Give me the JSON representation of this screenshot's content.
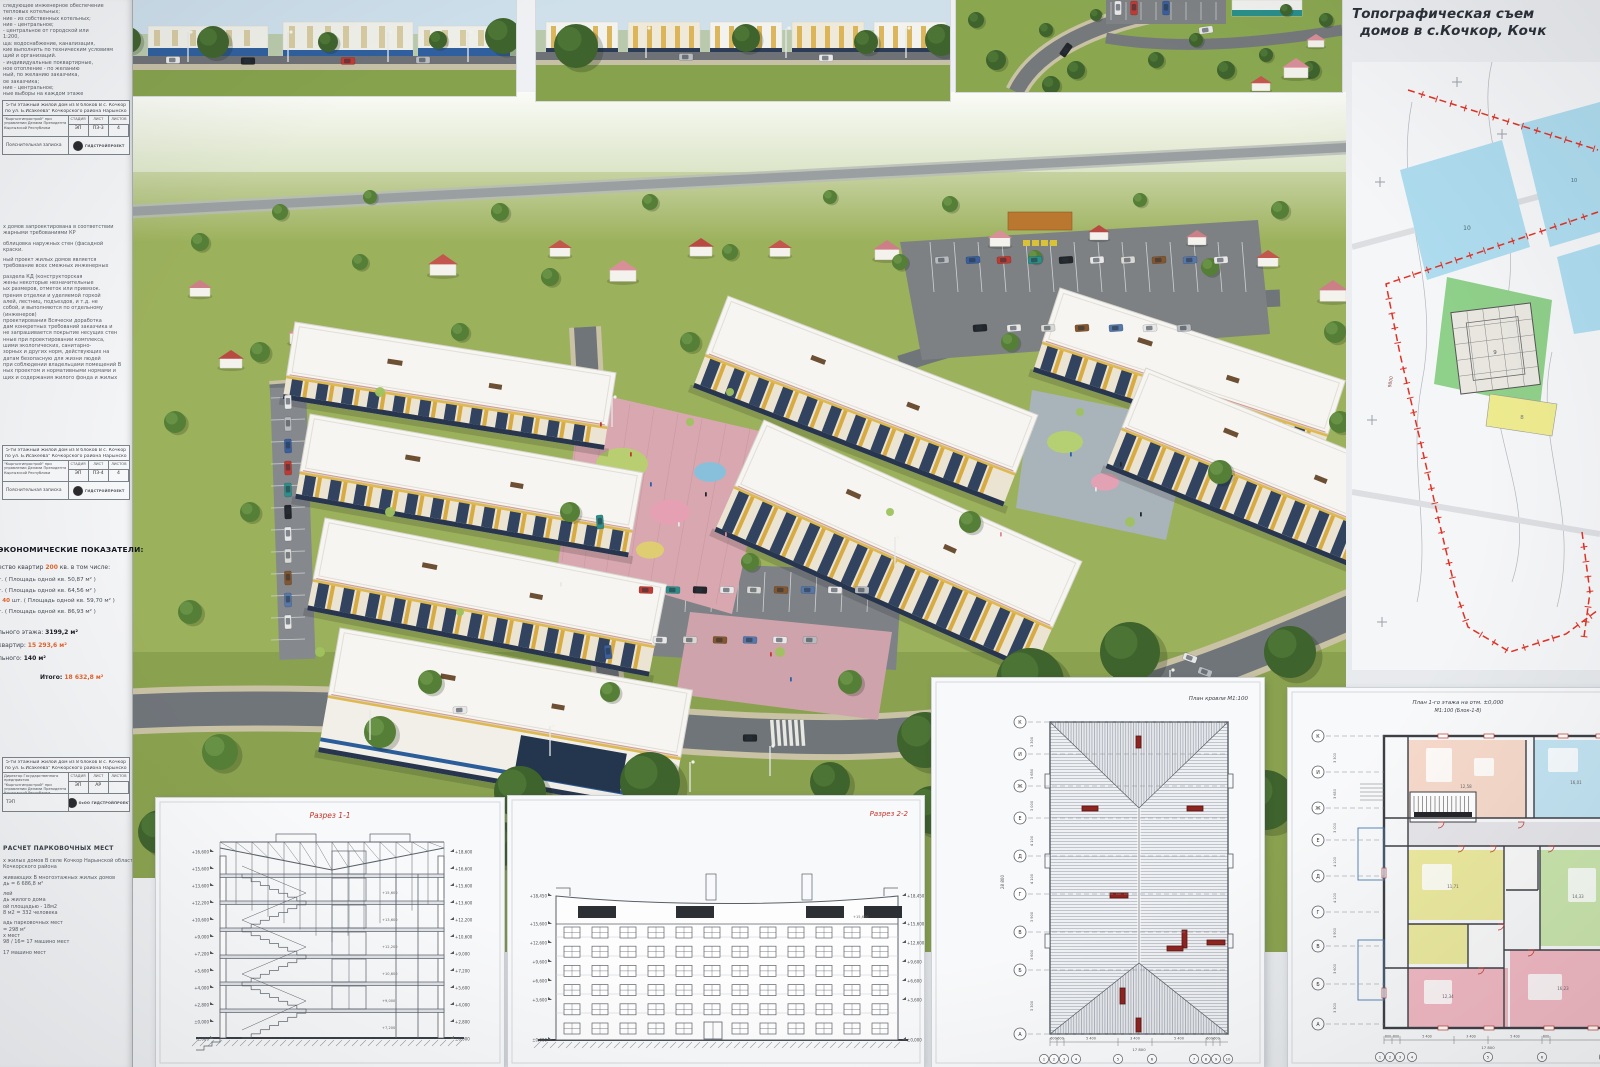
{
  "title_block": {
    "line1": "Топографическая съем",
    "line2": "домов в  с.Кочкор, Кочк"
  },
  "left_panel": {
    "top_note_lines": [
      "следующее инженерное обеспечение",
      "тепловых котельных;",
      "ние - из собственных котельных;",
      "ние - центральное;",
      "- центральное от городской или",
      "1:200,",
      "ща: водоснабжение, канализация,",
      "кие выполнить по техническим условиям",
      "щий и организаций.",
      "- индивидуальные поквартирные,",
      "ное отопление - по желанию",
      "ный, по желанию заказчика,",
      "ое заказчика;",
      "ние - центральное;",
      "ные выборы на каждом этаже"
    ],
    "paragraph_lines": [
      "х домов запроектирована в соответствии",
      "жарными требованиями КР",
      "",
      "облицовка наружных стен (фасадной",
      "краски.",
      "",
      "ный проект жилых домов  является",
      "требование всех смежных инженерных",
      "",
      "раздела КД (конструкторская",
      "жены некоторые незначительные",
      "ых размеров, отметок или привязок.",
      "прения отделки и уделяемой горкой",
      "алей, лестниц, подъездов, и т.д. не",
      "собой, и выполняются по отдельному",
      "(инженеров)",
      "проектирования Всячески доработка",
      "дам конкретных требований заказчика и",
      "не запрашивается покрытие несущих стен",
      "нные при проектировании комплекса,",
      "шими экологических, санитарно-",
      "зорных и других норм, действующих на",
      "датам безопасную для жизни людей",
      "при соблюдении владельцами помещений В",
      "ных проектом и нормативными нормами и",
      "щих и содержания жилого фонда и жилых"
    ],
    "stamps": [
      {
        "project_line1": "5-ти этажный жилой дом из 8 блоков В с. Кочкор",
        "project_line2": "по ул. Б.Исакеева\" Кочкорского района Нарынской области",
        "org": "\"Кыргызгипрострой\" при управлении Делами Президента Кыргызской Республики",
        "col_headers": [
          "СТАДИЯ",
          "ЛИСТ",
          "ЛИСТОВ"
        ],
        "col_values": [
          "ЭП",
          "ПЗ-3",
          "4"
        ],
        "doc_label": "Пояснительная записка",
        "seal_text": "ГИДСТРОЙПРОЕКТ"
      },
      {
        "project_line1": "5-ти этажный жилой дом из 8 блоков В с. Кочкор",
        "project_line2": "по ул. Б.Исакеева\" Кочкорского района Нарынской области",
        "org": "\"Кыргызгипрострой\" при управлении Делами Президента Кыргызской Республики",
        "col_headers": [
          "СТАДИЯ",
          "ЛИСТ",
          "ЛИСТОВ"
        ],
        "col_values": [
          "ЭП",
          "ПЗ-4",
          "4"
        ],
        "doc_label": "Пояснительная записка",
        "seal_text": "ГИДСТРОЙПРОЕКТ"
      },
      {
        "project_line1": "5-ти этажный жилой дом из 8 блоков В с. Кочкор",
        "project_line2": "по ул. Б.Исакеева\" Кочкорского района Нарынской области",
        "org": "Директор Государственного предприятия \"Кыргызгипрострой\" при управлении Делами Президента Кыргызской Республики",
        "col_headers": [
          "СТАДИЯ",
          "ЛИСТ",
          "ЛИСТОВ"
        ],
        "col_values": [
          "ЭП",
          "АР",
          ""
        ],
        "doc_label": "ТЭП",
        "seal_text": "ОсОО ГИДСТРОЙПРОЕКТ"
      }
    ],
    "economics": {
      "heading": "ЭКОНОМИЧЕСКИЕ ПОКАЗАТЕЛИ:",
      "quantity": {
        "pre": "ество квартир ",
        "hl": "200",
        "post": " кв. в том числе:"
      },
      "apartments": [
        {
          "hl": "",
          "text": "т. ( Площадь одной кв. 50,87 м² )"
        },
        {
          "hl": "",
          "text": "т. ( Площадь одной кв. 64,56 м² )"
        },
        {
          "hl": "- 40",
          "text": " шт. ( Площадь одной кв. 59,70 м² )"
        },
        {
          "hl": "",
          "text": "т. ( Площадь одной кв. 86,93 м² )"
        }
      ],
      "totals": [
        {
          "label": "льного этажа: ",
          "value": "3199,2 м²",
          "accent": false,
          "itogo": false
        },
        {
          "label": "квартир: ",
          "value": "15 293,6 м²",
          "accent": true,
          "itogo": false
        },
        {
          "label": "льного:   ",
          "value": "140 м²",
          "accent": false,
          "itogo": false
        },
        {
          "label": "Итого: ",
          "value": "18 632,8 м²",
          "accent": true,
          "itogo": true
        }
      ]
    },
    "parking": {
      "heading": "РАСЧЕТ ПАРКОВОЧНЫХ МЕСТ",
      "lines": [
        "х жилых домов В селе Кочкор Нарынской области",
        "Кочкорского района",
        "",
        "живающих В многоэтажных жилых домов",
        "дь = 6 686,8 м²",
        "",
        "лей",
        "дь жилого дома",
        "ой площадью - 18м2",
        "8 м2 = 332 человека",
        "",
        "адь парковочных мест",
        "= 298 м²",
        "х мест",
        "98 / 16= 17 машино мест",
        "",
        "17 машино мест"
      ]
    }
  },
  "sheets": {
    "section1": {
      "title": "Разрез 1-1",
      "marks_left": [
        "+16,600",
        "+15,600",
        "+13,600",
        "+12,200",
        "+10,600",
        "+9,000",
        "+7,200",
        "+5,600",
        "+4,000",
        "+2,800",
        "±0,000",
        "-1,000"
      ],
      "marks_right": [
        "+18,600",
        "+16,600",
        "+15,600",
        "+13,600",
        "+12,200",
        "+10,600",
        "+9,000",
        "+7,200",
        "+5,600",
        "+4,000",
        "+2,800",
        "±0,000"
      ]
    },
    "section2": {
      "title": "Разрез 2-2",
      "marks_left": [
        "+18,450",
        "+15,600",
        "+12,600",
        "+9,600",
        "+6,600",
        "+3,600",
        "±0,000"
      ],
      "marks_right": [
        "+18,450",
        "+15,600",
        "+12,600",
        "+9,600",
        "+6,600",
        "+3,600",
        "±0,000"
      ]
    },
    "roof": {
      "title": "План кровли  М1:100",
      "axes": [
        "К",
        "И",
        "Ж",
        "Е",
        "Д",
        "Г",
        "В",
        "Б",
        "А"
      ],
      "dims_left": [
        "3 300",
        "3 650",
        "3 000",
        "4 100",
        "4 100",
        "3 900",
        "3 600",
        "3 300"
      ],
      "total_left": "28 800",
      "dims_bottom": [
        "600",
        "600",
        "5 400",
        "3 400",
        "5 400",
        "600",
        "600"
      ],
      "total_bottom": "17 800",
      "axis_numbers": [
        "1",
        "2",
        "3",
        "4",
        "5",
        "6",
        "7",
        "8",
        "9",
        "10"
      ]
    },
    "floor": {
      "title_line1": "План 1-го этажа на отм. ±0,000",
      "title_line2": "М1:100  (Блок-1-8)",
      "axes": [
        "К",
        "И",
        "Ж",
        "Е",
        "Д",
        "Г",
        "В",
        "Б",
        "А"
      ],
      "dims_bottom": [
        "600",
        "600",
        "5 400",
        "3 400",
        "5 400",
        "600"
      ],
      "total_bottom": "17 800",
      "axis_numbers": [
        "1",
        "2",
        "3",
        "4",
        "5",
        "6",
        "7"
      ],
      "room_areas": [
        "12,58",
        "16,01",
        "14,33",
        "11,71",
        "16,23",
        "12,34"
      ]
    }
  },
  "site_plan": {
    "labels": [
      "10",
      "9",
      "8"
    ],
    "dim_label": "9800"
  },
  "colors": {
    "accent_red": "#c4342b",
    "accent_orange": "#e2622a",
    "plan_cyan": "#aedcef",
    "plan_green": "#8fd08a",
    "plan_yellow": "#eeeb8f",
    "boundary_red": "#e03226"
  }
}
